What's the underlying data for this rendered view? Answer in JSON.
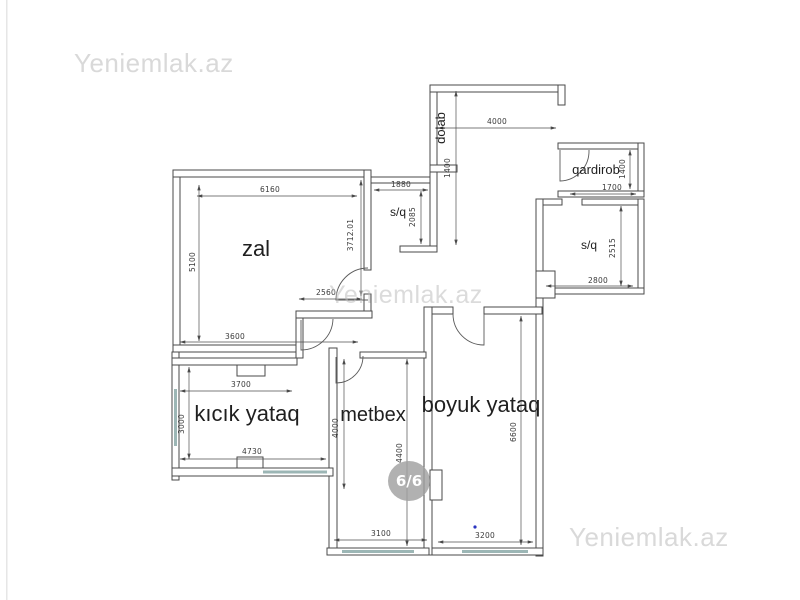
{
  "watermarks": {
    "top_left": "Yeniemlak.az",
    "center": "Yeniemlak.az",
    "bottom_right": "Yeniemlak.az"
  },
  "badge": {
    "label": "6/6"
  },
  "rooms": {
    "zal": {
      "label": "zal"
    },
    "sq_top": {
      "label": "s/q"
    },
    "dolab": {
      "label": "dolab"
    },
    "qardirob": {
      "label": "qardirob"
    },
    "sq_right": {
      "label": "s/q"
    },
    "kicik_yataq": {
      "label": "kıcık yataq"
    },
    "metbex": {
      "label": "metbex"
    },
    "boyuk_yataq": {
      "label": "boyuk yataq"
    }
  },
  "dimensions": [
    {
      "value": "6160",
      "room": "zal",
      "edge": "top"
    },
    {
      "value": "5100",
      "room": "zal",
      "edge": "left"
    },
    {
      "value": "3712.01",
      "room": "zal",
      "edge": "right"
    },
    {
      "value": "2560",
      "room": "zal",
      "edge": "alcove"
    },
    {
      "value": "3600",
      "room": "zal",
      "edge": "bottom"
    },
    {
      "value": "1880",
      "room": "s/q",
      "edge": "top"
    },
    {
      "value": "2085",
      "room": "s/q",
      "edge": "right"
    },
    {
      "value": "1400",
      "room": "dolab",
      "edge": "length"
    },
    {
      "value": "4000",
      "room": "entry hall",
      "edge": "top"
    },
    {
      "value": "1400",
      "room": "qardirob",
      "edge": "right"
    },
    {
      "value": "1700",
      "room": "qardirob",
      "edge": "bottom"
    },
    {
      "value": "2515",
      "room": "s/q",
      "edge": "right"
    },
    {
      "value": "2800",
      "room": "s/q",
      "edge": "bottom"
    },
    {
      "value": "3700",
      "room": "kıcık yataq",
      "edge": "top"
    },
    {
      "value": "3000",
      "room": "kıcık yataq",
      "edge": "left"
    },
    {
      "value": "4730",
      "room": "kıcık yataq",
      "edge": "bottom"
    },
    {
      "value": "4000",
      "room": "metbex",
      "edge": "left"
    },
    {
      "value": "4400",
      "room": "metbex",
      "edge": "right"
    },
    {
      "value": "6600",
      "room": "boyuk yataq",
      "edge": "right"
    },
    {
      "value": "3100",
      "room": "metbex",
      "edge": "bottom"
    },
    {
      "value": "3200",
      "room": "boyuk yataq",
      "edge": "bottom"
    }
  ],
  "colors": {
    "wall": "#4a4a4a",
    "window": "#9cb6b5",
    "watermark": "#d9d9d9",
    "watermark_center": "#bdbdbd",
    "badge_bg": "#a0a0a0",
    "badge_text": "#ffffff",
    "blue_dot": "#2b35c0"
  }
}
